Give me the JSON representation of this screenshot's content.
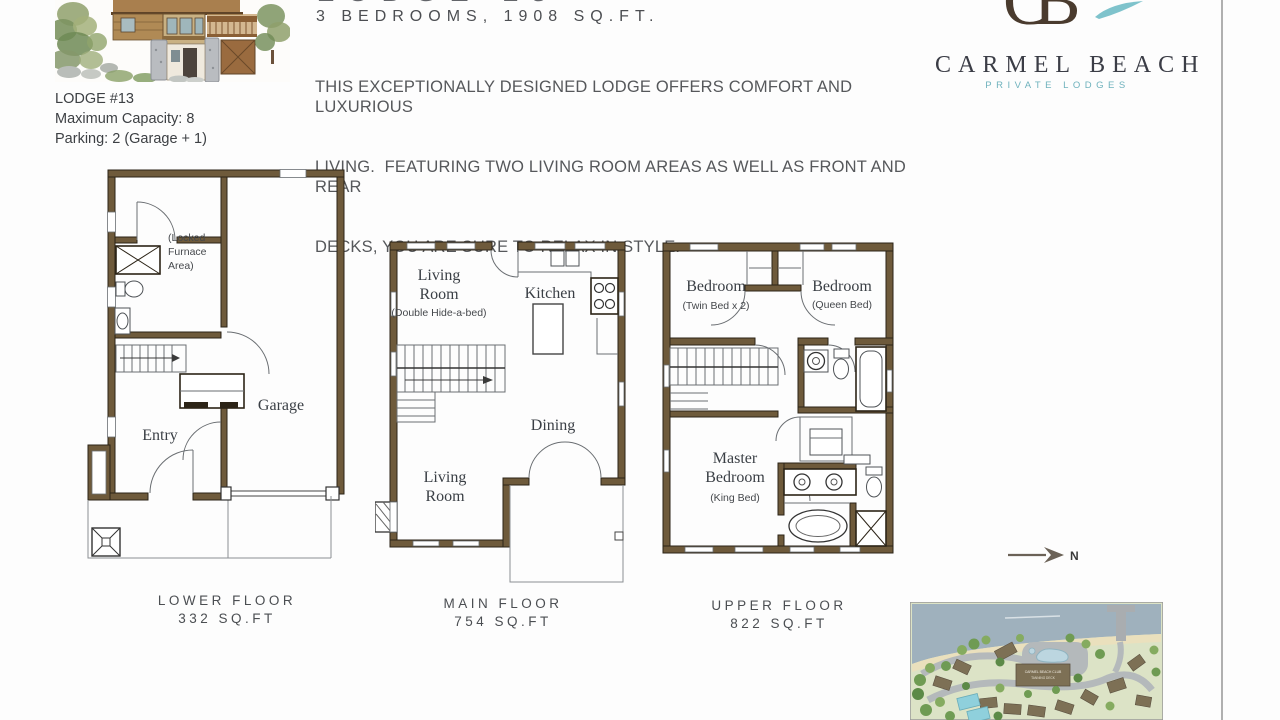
{
  "header": {
    "clipped_title": "LODGE 13",
    "subtitle": "3 BEDROOMS, 1908 SQ.FT.",
    "desc_line1": "THIS EXCEPTIONALLY DESIGNED LODGE OFFERS COMFORT AND LUXURIOUS",
    "desc_line2": "LIVING.  FEATURING TWO LIVING ROOM AREAS AS WELL AS FRONT AND REAR",
    "desc_line3": "DECKS, YOU ARE SURE TO RELAX IN STYLE."
  },
  "lodge_info": {
    "name": "LODGE #13",
    "capacity": "Maximum Capacity: 8",
    "parking": "Parking: 2 (Garage + 1)"
  },
  "brand": {
    "monogram": "CB",
    "name": "CARMEL BEACH",
    "tagline": "PRIVATE LODGES",
    "brand_color": "#4a3b2e",
    "accent_color": "#74b8c2"
  },
  "plans": {
    "wall_color": "#6e5a3b",
    "lower": {
      "caption": "LOWER FLOOR",
      "area": "332 SQ.FT",
      "labels": {
        "furnace1": "(Locked",
        "furnace2": "Furnace",
        "furnace3": "Area)",
        "entry": "Entry",
        "garage": "Garage"
      }
    },
    "main": {
      "caption": "MAIN FLOOR",
      "area": "754 SQ.FT",
      "labels": {
        "living1a": "Living",
        "living1b": "Room",
        "living_note": "(Double Hide-a-bed)",
        "kitchen": "Kitchen",
        "dining": "Dining",
        "living2a": "Living",
        "living2b": "Room"
      }
    },
    "upper": {
      "caption": "UPPER FLOOR",
      "area": "822 SQ.FT",
      "labels": {
        "bed1": "Bedroom",
        "bed1_note": "(Twin Bed x 2)",
        "bed2": "Bedroom",
        "bed2_note": "(Queen Bed)",
        "master1": "Master",
        "master2": "Bedroom",
        "master_note": "(King Bed)"
      }
    }
  },
  "compass": {
    "label": "N"
  },
  "site_map": {
    "club_line1": "CARMEL BEACH CLUB",
    "club_line2": "TANNING DECK"
  }
}
